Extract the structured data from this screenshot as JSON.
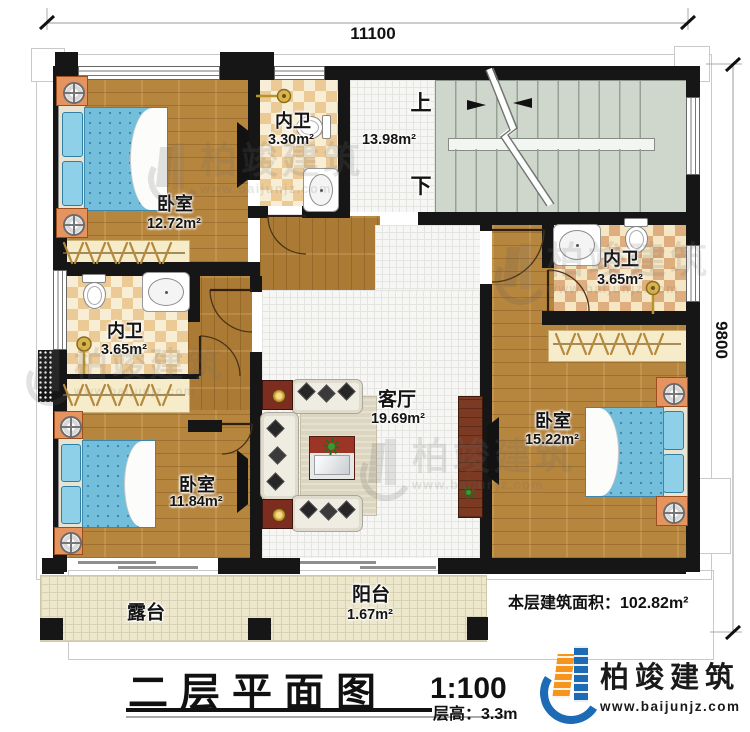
{
  "colors": {
    "wall": "#161616",
    "brand_blue": "#1d6bb5",
    "brand_orange": "#f7941d",
    "wood": "#b6853e",
    "stair": "#cfd7cd",
    "checker_tan": "#ebca96",
    "bed_blue": "#72bedb",
    "patio": "#ece7cd"
  },
  "dimensions": {
    "top": "11100",
    "right": "9800"
  },
  "stairs": {
    "up_label": "上",
    "down_label": "下"
  },
  "rooms": [
    {
      "id": "bedroom-tl",
      "name": "卧室",
      "area": "12.72m²"
    },
    {
      "id": "bath-top",
      "name": "内卫",
      "area": "3.30m²"
    },
    {
      "id": "hall",
      "name": "",
      "area": "13.98m²"
    },
    {
      "id": "bath-right",
      "name": "内卫",
      "area": "3.65m²"
    },
    {
      "id": "bath-left",
      "name": "内卫",
      "area": "3.65m²"
    },
    {
      "id": "living",
      "name": "客厅",
      "area": "19.69m²"
    },
    {
      "id": "bedroom-br",
      "name": "卧室",
      "area": "15.22m²"
    },
    {
      "id": "bedroom-bl",
      "name": "卧室",
      "area": "11.84m²"
    },
    {
      "id": "balcony",
      "name": "阳台",
      "area": "1.67m²"
    },
    {
      "id": "terrace",
      "name": "露台",
      "area": ""
    }
  ],
  "summary": {
    "label": "本层建筑面积：",
    "value": "102.82m²"
  },
  "title": {
    "text": "二层平面图",
    "scale": "1:100",
    "floor_height": "层高：3.3m"
  },
  "logo": {
    "name": "柏竣建筑",
    "url": "www.baijunjz.com"
  },
  "watermark": {
    "text": "柏竣建筑",
    "url": "www.baijunjz.com"
  },
  "icons": {
    "toilet": "css-shape",
    "sink": "css-shape",
    "shower": "css-shape",
    "lamp": "css-shape",
    "tv": "css-shape",
    "plant": "css-shape",
    "stair-break": "svg-line",
    "door-arc": "svg-arc"
  }
}
